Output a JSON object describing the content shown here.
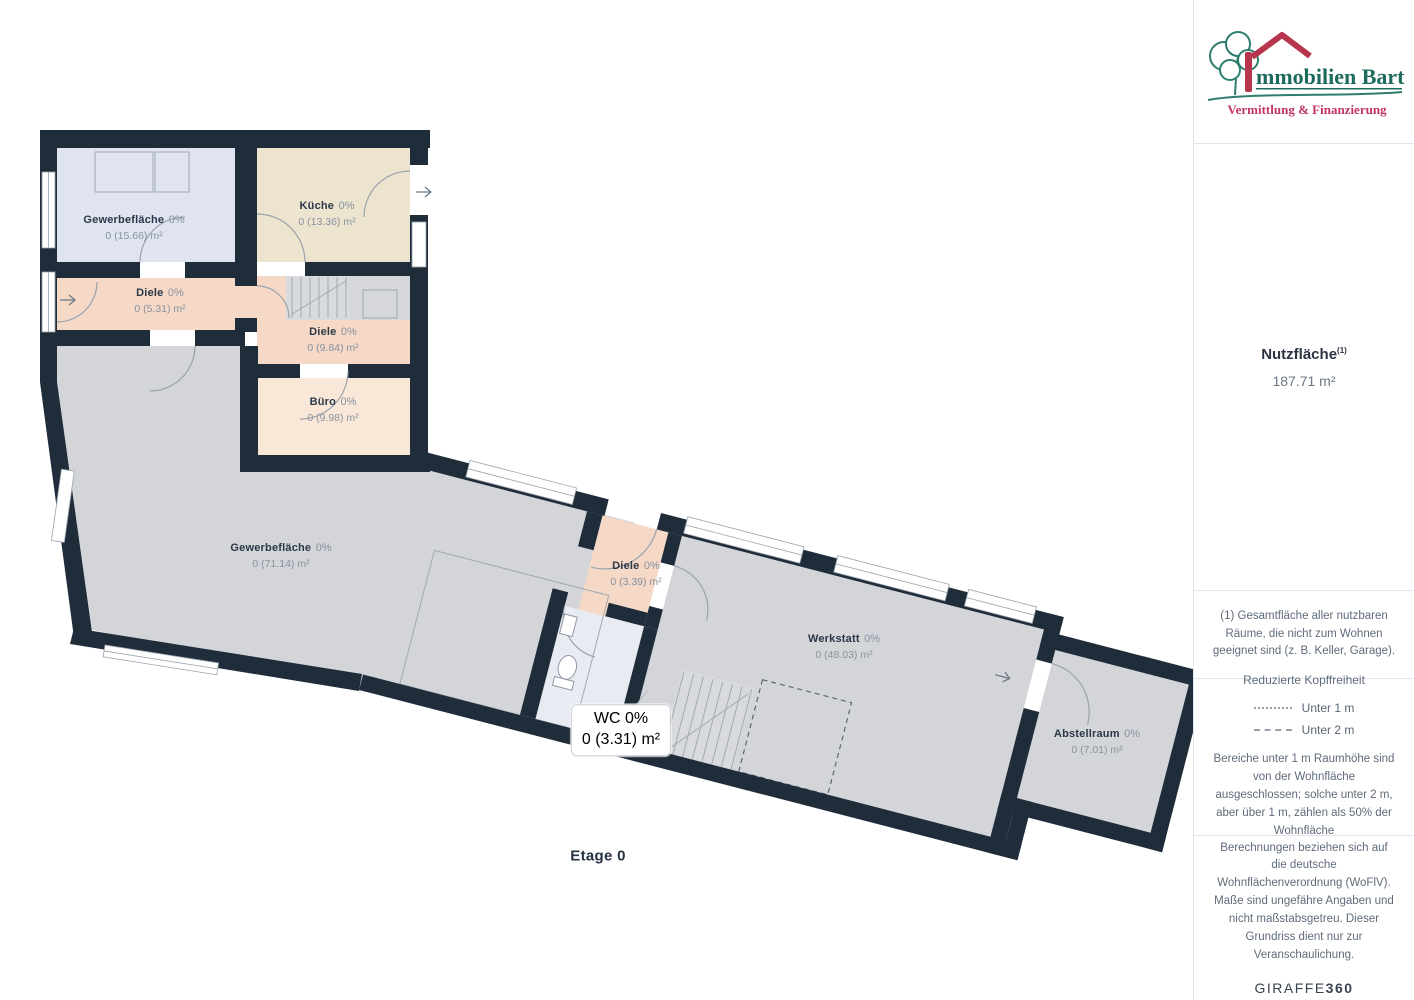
{
  "sidebar": {
    "logo": {
      "brand_initial": "I",
      "brand_rest": "mmobilien Bart",
      "tagline": "Vermittlung & Finanzierung",
      "brand_color": "#1d6b5e",
      "tagline_color": "#c13560",
      "roof_color": "#b8354e"
    },
    "summary": {
      "label": "Nutzfläche",
      "footnote_marker": "(1)",
      "value": "187.71 m²"
    },
    "footnote": "(1) Gesamtfläche aller nutzbaren Räume, die nicht zum Wohnen geeignet sind (z. B. Keller, Garage).",
    "legend": {
      "title": "Reduzierte Kopffreiheit",
      "items": [
        {
          "style": "dotted",
          "label": "Unter 1 m"
        },
        {
          "style": "dashed",
          "label": "Unter 2 m"
        }
      ],
      "note": "Bereiche unter 1 m Raumhöhe sind von der Wohnfläche ausgeschlossen; solche unter 2 m, aber über 1 m, zählen als 50% der Wohnfläche"
    },
    "disclaimer": "Berechnungen beziehen sich auf die deutsche Wohnflächenverordnung (WoFlV). Maße sind ungefähre Angaben und nicht maßstabsgetreu. Dieser Grundriss dient nur zur Veranschaulichung.",
    "vendor": {
      "name": "GIRAFFE",
      "suffix": "360"
    }
  },
  "plan": {
    "floor_label": "Etage 0",
    "rooms": [
      {
        "name": "Gewerbefläche",
        "pct": "0%",
        "area": "0 (15.66) m²"
      },
      {
        "name": "Küche",
        "pct": "0%",
        "area": "0 (13.36) m²"
      },
      {
        "name": "Diele",
        "pct": "0%",
        "area": "0 (5.31) m²"
      },
      {
        "name": "Diele",
        "pct": "0%",
        "area": "0 (9.84) m²"
      },
      {
        "name": "Büro",
        "pct": "0%",
        "area": "0 (9.98) m²"
      },
      {
        "name": "Gewerbefläche",
        "pct": "0%",
        "area": "0 (71.14) m²"
      },
      {
        "name": "Diele",
        "pct": "0%",
        "area": "0 (3.39) m²"
      },
      {
        "name": "Werkstatt",
        "pct": "0%",
        "area": "0 (48.03) m²"
      },
      {
        "name": "WC",
        "pct": "0%",
        "area": "0 (3.31) m²"
      },
      {
        "name": "Abstellraum",
        "pct": "0%",
        "area": "0 (7.01) m²"
      }
    ],
    "colors": {
      "wall": "#1f2c3a",
      "room_commercial_small": "#dfe4f0",
      "room_kitchen": "#ece4cf",
      "room_hall": "#f5d9c6",
      "room_office": "#f9e8d8",
      "room_gray": "#d3d5d9",
      "room_wc": "#e8ebf1"
    }
  }
}
